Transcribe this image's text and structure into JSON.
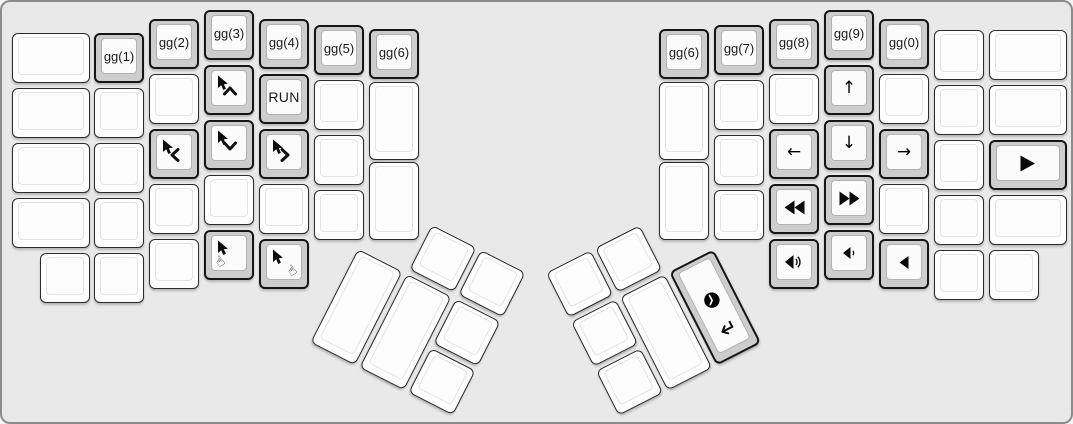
{
  "canvas": {
    "background": "#e9e9e9",
    "frame_border": "#8c8c8c",
    "key_white": "#ffffff",
    "key_gray": "#cdcdcd",
    "keytop": "#fdfdfd",
    "legend_color": "#1a1a1a"
  },
  "legends": {
    "gg1": "gg(1)",
    "gg2": "gg(2)",
    "gg3": "gg(3)",
    "gg4": "gg(4)",
    "gg5": "gg(5)",
    "gg6": "gg(6)",
    "gg7": "gg(7)",
    "gg8": "gg(8)",
    "gg9": "gg(9)",
    "gg0": "gg(0)",
    "run": "RUN"
  },
  "layout": {
    "unit_px": 55,
    "groups": [
      {
        "name": "left-main-block",
        "x": 0,
        "y": 0,
        "rotation": 0,
        "keys": [
          {
            "x": 10,
            "y": 31,
            "w": 1.5
          },
          {
            "x": 10,
            "y": 86,
            "w": 1.5
          },
          {
            "x": 10,
            "y": 141,
            "w": 1.5
          },
          {
            "x": 10,
            "y": 196,
            "w": 1.5
          },
          {
            "x": 38,
            "y": 251
          },
          {
            "x": 92,
            "y": 31,
            "label": "gg(1)",
            "gray": true,
            "name": "key-gg-1"
          },
          {
            "x": 92,
            "y": 86
          },
          {
            "x": 92,
            "y": 141
          },
          {
            "x": 92,
            "y": 196
          },
          {
            "x": 92,
            "y": 251
          },
          {
            "x": 147,
            "y": 17,
            "label": "gg(2)",
            "gray": true,
            "name": "key-gg-2"
          },
          {
            "x": 147,
            "y": 72
          },
          {
            "x": 147,
            "y": 127,
            "gray": true,
            "name": "key-mouse-left",
            "icons": [
              "mouse-cursor",
              "chevron-left"
            ]
          },
          {
            "x": 147,
            "y": 182
          },
          {
            "x": 147,
            "y": 237
          },
          {
            "x": 202,
            "y": 8,
            "label": "gg(3)",
            "gray": true,
            "name": "key-gg-3"
          },
          {
            "x": 202,
            "y": 63,
            "gray": true,
            "name": "key-mouse-up",
            "icons": [
              "mouse-cursor",
              "chevron-up"
            ]
          },
          {
            "x": 202,
            "y": 118,
            "gray": true,
            "name": "key-mouse-down",
            "icons": [
              "mouse-cursor",
              "chevron-down"
            ]
          },
          {
            "x": 202,
            "y": 173
          },
          {
            "x": 202,
            "y": 228,
            "gray": true,
            "name": "key-mouse-button-left",
            "icons": [
              "mouse-cursor",
              "hand-left"
            ]
          },
          {
            "x": 257,
            "y": 17,
            "label": "gg(4)",
            "gray": true,
            "name": "key-gg-4"
          },
          {
            "x": 257,
            "y": 72,
            "label": "RUN",
            "big": true,
            "gray": true,
            "name": "key-run"
          },
          {
            "x": 257,
            "y": 127,
            "gray": true,
            "name": "key-mouse-right",
            "icons": [
              "mouse-cursor",
              "chevron-right"
            ]
          },
          {
            "x": 257,
            "y": 182
          },
          {
            "x": 257,
            "y": 237,
            "gray": true,
            "name": "key-mouse-button-right",
            "icons": [
              "mouse-cursor",
              "hand-right"
            ]
          },
          {
            "x": 312,
            "y": 23,
            "label": "gg(5)",
            "gray": true,
            "name": "key-gg-5"
          },
          {
            "x": 312,
            "y": 78
          },
          {
            "x": 312,
            "y": 133
          },
          {
            "x": 312,
            "y": 188
          },
          {
            "x": 367,
            "y": 27,
            "label": "gg(6)",
            "gray": true,
            "name": "key-gg-6"
          },
          {
            "x": 367,
            "y": 80,
            "h": 1.5
          },
          {
            "x": 367,
            "y": 160,
            "h": 1.5
          }
        ]
      },
      {
        "name": "right-main-block",
        "x": 0,
        "y": 0,
        "rotation": 0,
        "keys": [
          {
            "x": 657,
            "y": 27,
            "label": "gg(6)",
            "gray": true,
            "name": "key-gg-6-right"
          },
          {
            "x": 657,
            "y": 80,
            "h": 1.5
          },
          {
            "x": 657,
            "y": 160,
            "h": 1.5
          },
          {
            "x": 712,
            "y": 23,
            "label": "gg(7)",
            "gray": true,
            "name": "key-gg-7"
          },
          {
            "x": 712,
            "y": 78
          },
          {
            "x": 712,
            "y": 133
          },
          {
            "x": 712,
            "y": 188
          },
          {
            "x": 767,
            "y": 17,
            "label": "gg(8)",
            "gray": true,
            "name": "key-gg-8"
          },
          {
            "x": 767,
            "y": 72
          },
          {
            "x": 767,
            "y": 127,
            "gray": true,
            "name": "key-arrow-left",
            "icons": [
              "arrow-left"
            ]
          },
          {
            "x": 767,
            "y": 182,
            "gray": true,
            "name": "key-rewind",
            "icons": [
              "rewind"
            ]
          },
          {
            "x": 767,
            "y": 237,
            "gray": true,
            "name": "key-volume-up",
            "icons": [
              "volume-up"
            ]
          },
          {
            "x": 822,
            "y": 8,
            "label": "gg(9)",
            "gray": true,
            "name": "key-gg-9"
          },
          {
            "x": 822,
            "y": 63,
            "gray": true,
            "name": "key-arrow-up",
            "icons": [
              "arrow-up"
            ]
          },
          {
            "x": 822,
            "y": 118,
            "gray": true,
            "name": "key-arrow-down",
            "icons": [
              "arrow-down"
            ]
          },
          {
            "x": 822,
            "y": 173,
            "gray": true,
            "name": "key-fast-forward",
            "icons": [
              "fast-forward"
            ]
          },
          {
            "x": 822,
            "y": 228,
            "gray": true,
            "name": "key-volume-down",
            "icons": [
              "volume-down"
            ]
          },
          {
            "x": 877,
            "y": 17,
            "label": "gg(0)",
            "gray": true,
            "name": "key-gg-0"
          },
          {
            "x": 877,
            "y": 72
          },
          {
            "x": 877,
            "y": 127,
            "gray": true,
            "name": "key-arrow-right",
            "icons": [
              "arrow-right"
            ]
          },
          {
            "x": 877,
            "y": 182
          },
          {
            "x": 877,
            "y": 237,
            "gray": true,
            "name": "key-mute",
            "icons": [
              "volume-mute"
            ]
          },
          {
            "x": 932,
            "y": 28
          },
          {
            "x": 932,
            "y": 83
          },
          {
            "x": 932,
            "y": 138
          },
          {
            "x": 932,
            "y": 193
          },
          {
            "x": 932,
            "y": 248
          },
          {
            "x": 987,
            "y": 28,
            "w": 1.5
          },
          {
            "x": 987,
            "y": 83,
            "w": 1.5
          },
          {
            "x": 987,
            "y": 138,
            "w": 1.5,
            "gray": true,
            "name": "key-play",
            "icons": [
              "play"
            ]
          },
          {
            "x": 987,
            "y": 193,
            "w": 1.5
          },
          {
            "x": 987,
            "y": 248
          }
        ]
      },
      {
        "name": "left-thumb-cluster",
        "x": 381,
        "y": 198,
        "rotation": 27,
        "keys": [
          {
            "x": 55,
            "y": 0
          },
          {
            "x": 110,
            "y": 0
          },
          {
            "x": 0,
            "y": 55,
            "h": 2
          },
          {
            "x": 55,
            "y": 55,
            "h": 2
          },
          {
            "x": 110,
            "y": 55
          },
          {
            "x": 110,
            "y": 110
          }
        ]
      },
      {
        "name": "right-thumb-cluster",
        "x": 544,
        "y": 271,
        "rotation": -27,
        "keys": [
          {
            "x": 0,
            "y": 0
          },
          {
            "x": 55,
            "y": 0
          },
          {
            "x": 0,
            "y": 55
          },
          {
            "x": 0,
            "y": 110
          },
          {
            "x": 55,
            "y": 55,
            "h": 2
          },
          {
            "x": 110,
            "y": 55,
            "h": 2,
            "gray": true,
            "stack": true,
            "name": "key-clock-enter",
            "icons": [
              "clock",
              "return"
            ]
          }
        ]
      }
    ]
  }
}
